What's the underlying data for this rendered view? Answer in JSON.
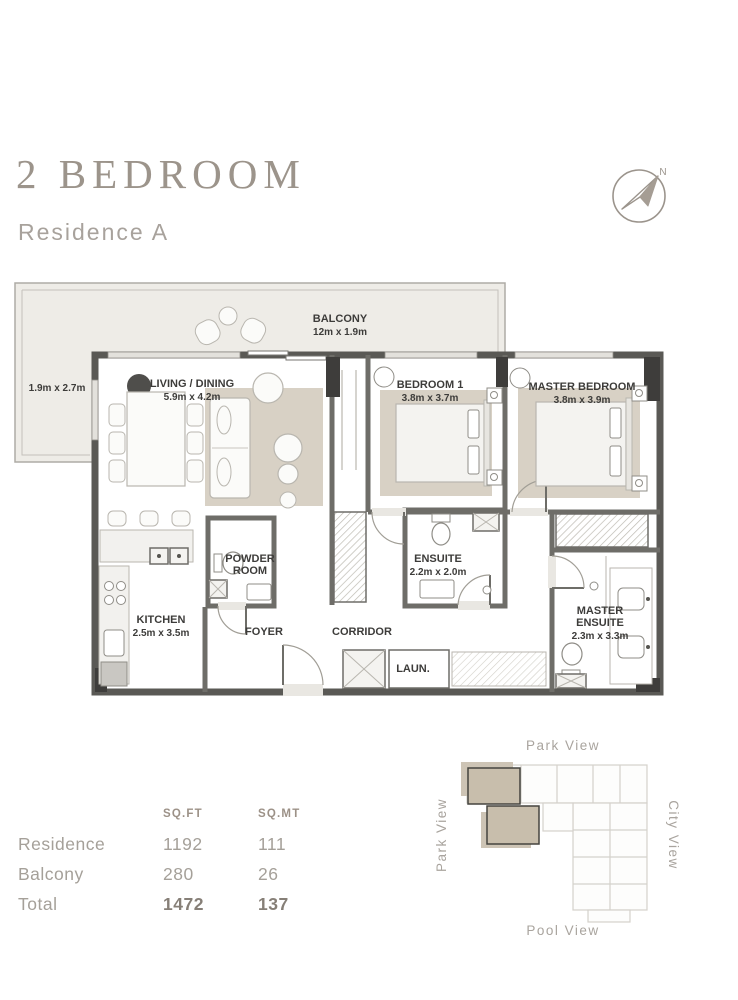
{
  "header": {
    "title": "2 BEDROOM",
    "subtitle": "Residence A"
  },
  "compass": {
    "north_label": "N"
  },
  "floorplan": {
    "balcony": {
      "name": "BALCONY",
      "dims": "12m x 1.9m"
    },
    "balcony_side": {
      "dims": "1.9m x 2.7m"
    },
    "living_dining": {
      "name": "LIVING / DINING",
      "dims": "5.9m x 4.2m"
    },
    "bedroom_1": {
      "name": "BEDROOM 1",
      "dims": "3.8m x 3.7m"
    },
    "master_bedroom": {
      "name": "MASTER BEDROOM",
      "dims": "3.8m x 3.9m"
    },
    "kitchen": {
      "name": "KITCHEN",
      "dims": "2.5m x 3.5m"
    },
    "powder_room": {
      "line1": "POWDER",
      "line2": "ROOM"
    },
    "foyer": {
      "name": "FOYER"
    },
    "corridor": {
      "name": "CORRIDOR"
    },
    "ensuite": {
      "name": "ENSUITE",
      "dims": "2.2m x 2.0m"
    },
    "master_ensuite": {
      "line1": "MASTER",
      "line2": "ENSUITE",
      "dims": "2.3m x 3.3m"
    },
    "laundry": {
      "name": "LAUN."
    }
  },
  "area_table": {
    "col_sqft": "SQ.FT",
    "col_sqmt": "SQ.MT",
    "rows": [
      {
        "label": "Residence",
        "sqft": "1192",
        "sqmt": "111"
      },
      {
        "label": "Balcony",
        "sqft": "280",
        "sqmt": "26"
      },
      {
        "label": "Total",
        "sqft": "1472",
        "sqmt": "137"
      }
    ]
  },
  "site_map": {
    "top": "Park View",
    "left": "Park View",
    "right": "City View",
    "bottom": "Pool View"
  },
  "colors": {
    "accent": "#9c948b",
    "text_muted": "#a8a29c",
    "plan_label": "#3d3c3a",
    "wall": "#5a5955",
    "room_fill": "#e9e7e2",
    "rug_fill": "#d8d1c5",
    "balcony_fill": "#eeece7",
    "highlight_unit": "#c8beac",
    "table_text": "#a5a099",
    "table_strong": "#867f77"
  }
}
